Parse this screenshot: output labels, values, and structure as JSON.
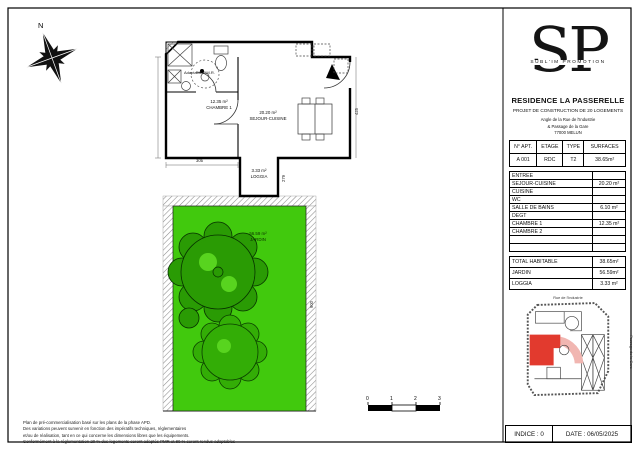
{
  "logo": {
    "monogram": "SP",
    "subtitle": "SUBL'IM PROMOTION"
  },
  "project": {
    "residence": "RESIDENCE LA PASSERELLE",
    "subtitle": "PROJET DE CONSTRUCTION DE 20 LOGEMENTS",
    "address_line1": "Angle de la Rue de l'Industrie",
    "address_line2": "& Passage de la Gare",
    "address_line3": "77000 MELUN"
  },
  "apt_table": {
    "headers": [
      "N° APT.",
      "ETAGE",
      "TYPE",
      "SURFACES"
    ],
    "row": [
      "A 001",
      "RDC",
      "T2",
      "38.65m²"
    ]
  },
  "rooms_table": {
    "rows": [
      {
        "label": "ENTREE",
        "value": ""
      },
      {
        "label": "SEJOUR-CUISINE",
        "value": "20.20 m²"
      },
      {
        "label": "CUISINE",
        "value": ""
      },
      {
        "label": "WC",
        "value": ""
      },
      {
        "label": "SALLE DE BAINS",
        "value": "6.10 m²"
      },
      {
        "label": "DEGT",
        "value": ""
      },
      {
        "label": "CHAMBRE 1",
        "value": "12.35 m²"
      },
      {
        "label": "CHAMBRE 2",
        "value": ""
      },
      {
        "label": "",
        "value": ""
      },
      {
        "label": "",
        "value": ""
      }
    ],
    "totals": [
      {
        "label": "TOTAL HABITABLE",
        "value": "38.65m²"
      },
      {
        "label": "JARDIN",
        "value": "56.59m²"
      },
      {
        "label": "LOGGIA",
        "value": "3.33 m²"
      }
    ]
  },
  "plan": {
    "north": "N",
    "pmr_note": "Adaptable P.M.R.",
    "labels": {
      "chambre": {
        "area": "12.35 m²",
        "name": "CHAMBRE 1"
      },
      "sejour": {
        "area": "20.20 m²",
        "name": "SEJOUR-CUISINE"
      },
      "loggia": {
        "area": "3.33 m²",
        "name": "LOGGIA"
      },
      "jardin": {
        "area": "56.59 m²",
        "name": "JARDIN"
      }
    },
    "dims": [
      "305",
      "425",
      "279",
      "900"
    ],
    "scalebar": [
      "0",
      "1",
      "2",
      "3"
    ]
  },
  "site_map": {
    "street_top": "Rue de l'Industrie",
    "street_right": "Passage de la Gare"
  },
  "footer": {
    "indice": "INDICE : 0",
    "date": "DATE : 06/05/2025"
  },
  "disclaimer": {
    "lines": [
      "Plan de pré-commercialisation basé sur les plans de la phase APD.",
      "Des variations peuvent survenir en fonction des impératifs techniques, réglementaires",
      "et/ou de réalisation, tant en ce qui concerne les dimensions libres que les équipements.",
      "Conformément à la réglementation 20 % des logements seront adaptés PMR et 80 % seront rendus adaptables"
    ]
  },
  "colors": {
    "garden": "#41c90d",
    "tree_dark": "#2a9b04",
    "tree_mid": "#33ad06",
    "tree_light": "#58d41f",
    "unit_red": "#e23a2e",
    "swoosh_pink": "#f1b6b1"
  }
}
